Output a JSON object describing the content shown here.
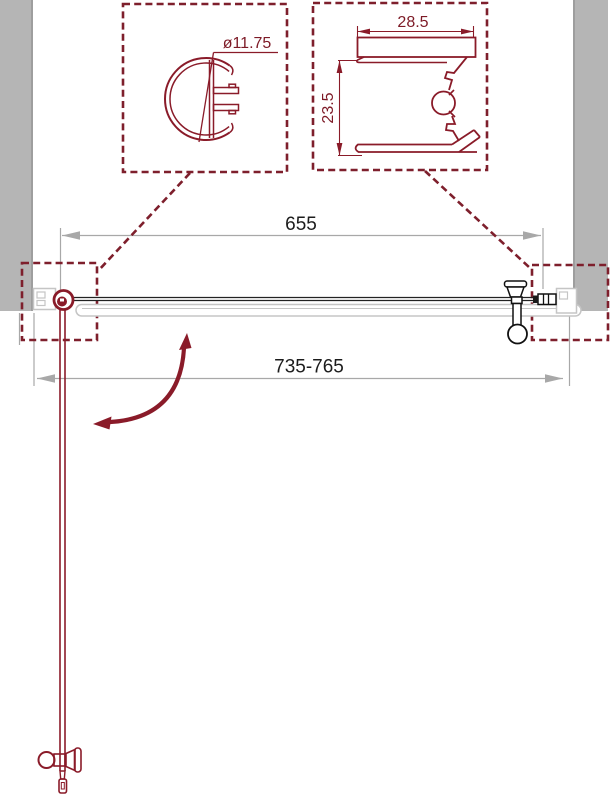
{
  "diagram": {
    "kind": "technical drawing, top view of pivot shower door between two walls",
    "dimensions": {
      "glass_width": "655",
      "overall_width": "735-765",
      "knob_profile_diameter": "ø11.75",
      "wall_profile_width": "28.5",
      "wall_profile_depth": "23.5"
    },
    "colors": {
      "line_maroon": "#8a1b29",
      "text_maroon": "#7d1a26",
      "text_black": "#1c1c1c",
      "wall_gray": "#b5b5b5",
      "dimension_gray": "#a8a8a8",
      "profile_light_gray": "#c5c5c5"
    }
  }
}
